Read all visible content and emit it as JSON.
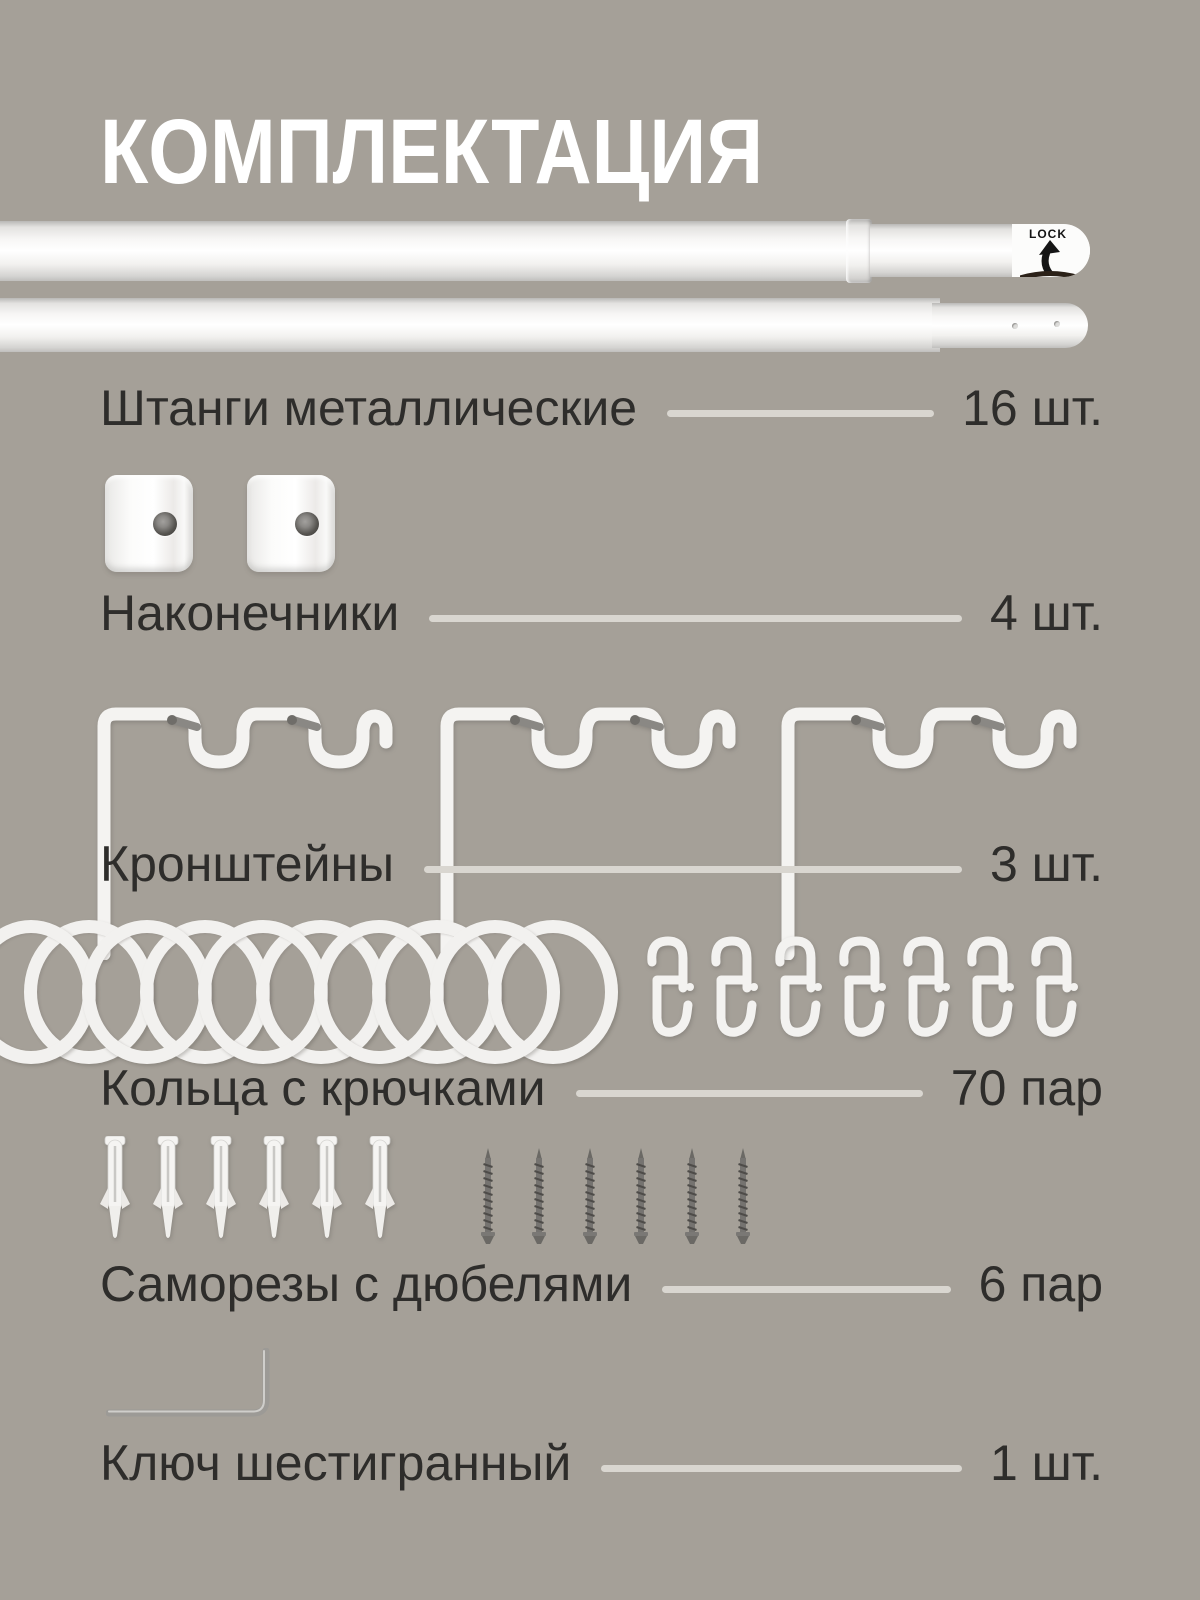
{
  "page": {
    "title": "КОМПЛЕКТАЦИЯ"
  },
  "colors": {
    "background": "#a5a098",
    "title_text": "#ffffff",
    "item_text": "#2e2d2b",
    "dash_line": "#d9d6d0",
    "product_white": "#f2f1ef",
    "metal_gray": "#8a8884"
  },
  "rod": {
    "lock_label": "LOCK"
  },
  "icons": [
    "rod-image",
    "lock-arrow-icon",
    "finial-image",
    "bracket-icon",
    "ring-icon",
    "hook-icon",
    "dowel-icon",
    "screw-icon",
    "hex-key-icon"
  ],
  "items": [
    {
      "id": "rods",
      "label": "Штанги металлические",
      "value": "16 шт."
    },
    {
      "id": "finials",
      "label": "Наконечники",
      "value": "4 шт."
    },
    {
      "id": "brackets",
      "label": "Кронштейны",
      "value": "3 шт."
    },
    {
      "id": "rings",
      "label": "Кольца с крючками",
      "value": "70 пар"
    },
    {
      "id": "screws",
      "label": "Саморезы с дюбелями",
      "value": "6 пар"
    },
    {
      "id": "hexkey",
      "label": "Ключ шестигранный",
      "value": "1 шт."
    }
  ]
}
